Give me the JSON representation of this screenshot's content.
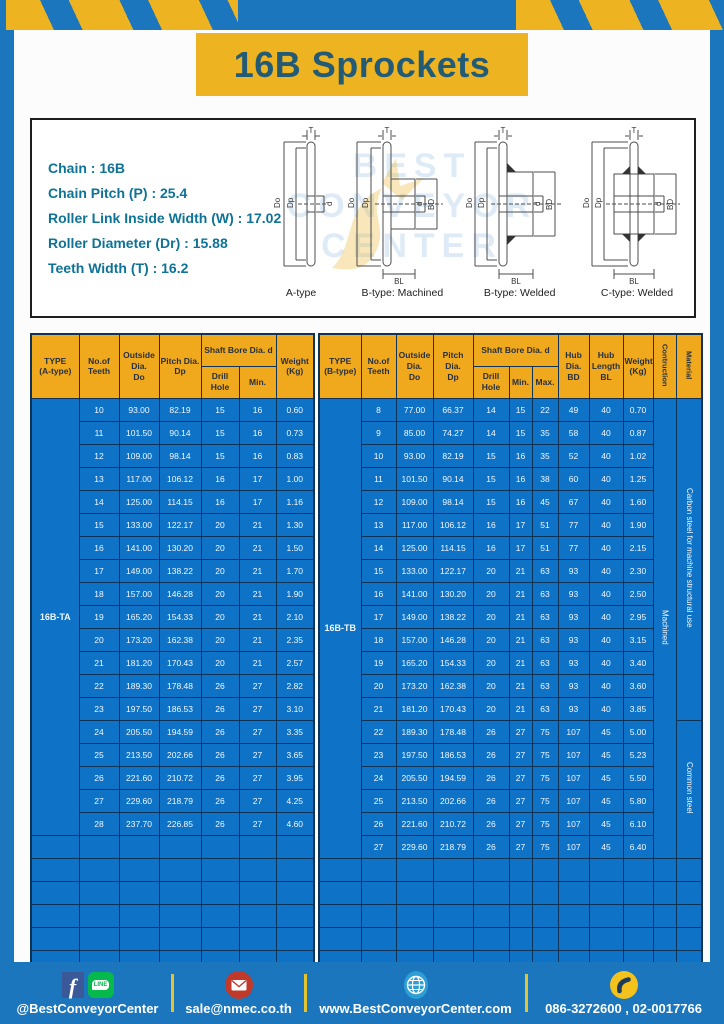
{
  "page": {
    "title": "16B Sprockets"
  },
  "colors": {
    "frame_blue": "#1b76bd",
    "banner_yellow": "#eeb321",
    "header_yellow": "#f0a91c",
    "table_blue": "#0e73c6",
    "title_text": "#235b77"
  },
  "specs": {
    "lines": [
      "Chain : 16B",
      "Chain Pitch (P) : 25.4",
      "Roller Link Inside Width (W) : 17.02",
      "Roller Diameter (Dr) : 15.88",
      "Teeth Width (T) : 16.2"
    ]
  },
  "diagram": {
    "captions": [
      "A-type",
      "B-type: Machined",
      "B-type: Welded",
      "C-type: Welded"
    ],
    "dims": {
      "T": "T",
      "Do": "Do",
      "Dp": "Dp",
      "d": "d",
      "BD": "BD",
      "BL": "BL"
    },
    "watermark_lines": [
      "BEST",
      "CONVEYOR",
      "CENTER"
    ]
  },
  "table_a": {
    "headers": {
      "type": "TYPE\n(A-type)",
      "teeth": "No.of\nTeeth",
      "outside": "Outside\nDia.\nDo",
      "pitch": "Pitch Dia.\nDp",
      "shaft_bore": "Shaft Bore Dia. d",
      "drill": "Drill Hole",
      "min": "Min.",
      "weight": "Weight\n(Kg)"
    },
    "type_label": "16B-TA",
    "rows": [
      [
        "10",
        "93.00",
        "82.19",
        "15",
        "16",
        "0.60"
      ],
      [
        "11",
        "101.50",
        "90.14",
        "15",
        "16",
        "0.73"
      ],
      [
        "12",
        "109.00",
        "98.14",
        "15",
        "16",
        "0.83"
      ],
      [
        "13",
        "117.00",
        "106.12",
        "16",
        "17",
        "1.00"
      ],
      [
        "14",
        "125.00",
        "114.15",
        "16",
        "17",
        "1.16"
      ],
      [
        "15",
        "133.00",
        "122.17",
        "20",
        "21",
        "1.30"
      ],
      [
        "16",
        "141.00",
        "130.20",
        "20",
        "21",
        "1.50"
      ],
      [
        "17",
        "149.00",
        "138.22",
        "20",
        "21",
        "1.70"
      ],
      [
        "18",
        "157.00",
        "146.28",
        "20",
        "21",
        "1.90"
      ],
      [
        "19",
        "165.20",
        "154.33",
        "20",
        "21",
        "2.10"
      ],
      [
        "20",
        "173.20",
        "162.38",
        "20",
        "21",
        "2.35"
      ],
      [
        "21",
        "181.20",
        "170.43",
        "20",
        "21",
        "2.57"
      ],
      [
        "22",
        "189.30",
        "178.48",
        "26",
        "27",
        "2.82"
      ],
      [
        "23",
        "197.50",
        "186.53",
        "26",
        "27",
        "3.10"
      ],
      [
        "24",
        "205.50",
        "194.59",
        "26",
        "27",
        "3.35"
      ],
      [
        "25",
        "213.50",
        "202.66",
        "26",
        "27",
        "3.65"
      ],
      [
        "26",
        "221.60",
        "210.72",
        "26",
        "27",
        "3.95"
      ],
      [
        "27",
        "229.60",
        "218.79",
        "26",
        "27",
        "4.25"
      ],
      [
        "28",
        "237.70",
        "226.85",
        "26",
        "27",
        "4.60"
      ]
    ],
    "empty_rows": 6
  },
  "table_b": {
    "headers": {
      "type": "TYPE\n(B-type)",
      "teeth": "No.of\nTeeth",
      "outside": "Outside\nDia.\nDo",
      "pitch": "Pitch Dia.\nDp",
      "shaft_bore": "Shaft Bore Dia. d",
      "drill": "Drill Hole",
      "min": "Min.",
      "max": "Max.",
      "hub_dia": "Hub Dia.\nBD",
      "hub_length": "Hub\nLength\nBL",
      "weight": "Weight\n(Kg)",
      "construction": "Contruction",
      "material": "Material"
    },
    "type_label": "16B-TB",
    "construction": "Machined",
    "materials": [
      {
        "label": "Carbon steel for machine structural use",
        "rows": 14
      },
      {
        "label": "Common steel",
        "rows": 6
      }
    ],
    "rows": [
      [
        "8",
        "77.00",
        "66.37",
        "14",
        "15",
        "22",
        "49",
        "40",
        "0.70"
      ],
      [
        "9",
        "85.00",
        "74.27",
        "14",
        "15",
        "35",
        "58",
        "40",
        "0.87"
      ],
      [
        "10",
        "93.00",
        "82.19",
        "15",
        "16",
        "35",
        "52",
        "40",
        "1.02"
      ],
      [
        "11",
        "101.50",
        "90.14",
        "15",
        "16",
        "38",
        "60",
        "40",
        "1.25"
      ],
      [
        "12",
        "109.00",
        "98.14",
        "15",
        "16",
        "45",
        "67",
        "40",
        "1.60"
      ],
      [
        "13",
        "117.00",
        "106.12",
        "16",
        "17",
        "51",
        "77",
        "40",
        "1.90"
      ],
      [
        "14",
        "125.00",
        "114.15",
        "16",
        "17",
        "51",
        "77",
        "40",
        "2.15"
      ],
      [
        "15",
        "133.00",
        "122.17",
        "20",
        "21",
        "63",
        "93",
        "40",
        "2.30"
      ],
      [
        "16",
        "141.00",
        "130.20",
        "20",
        "21",
        "63",
        "93",
        "40",
        "2.50"
      ],
      [
        "17",
        "149.00",
        "138.22",
        "20",
        "21",
        "63",
        "93",
        "40",
        "2.95"
      ],
      [
        "18",
        "157.00",
        "146.28",
        "20",
        "21",
        "63",
        "93",
        "40",
        "3.15"
      ],
      [
        "19",
        "165.20",
        "154.33",
        "20",
        "21",
        "63",
        "93",
        "40",
        "3.40"
      ],
      [
        "20",
        "173.20",
        "162.38",
        "20",
        "21",
        "63",
        "93",
        "40",
        "3.60"
      ],
      [
        "21",
        "181.20",
        "170.43",
        "20",
        "21",
        "63",
        "93",
        "40",
        "3.85"
      ],
      [
        "22",
        "189.30",
        "178.48",
        "26",
        "27",
        "75",
        "107",
        "45",
        "5.00"
      ],
      [
        "23",
        "197.50",
        "186.53",
        "26",
        "27",
        "75",
        "107",
        "45",
        "5.23"
      ],
      [
        "24",
        "205.50",
        "194.59",
        "26",
        "27",
        "75",
        "107",
        "45",
        "5.50"
      ],
      [
        "25",
        "213.50",
        "202.66",
        "26",
        "27",
        "75",
        "107",
        "45",
        "5.80"
      ],
      [
        "26",
        "221.60",
        "210.72",
        "26",
        "27",
        "75",
        "107",
        "45",
        "6.10"
      ],
      [
        "27",
        "229.60",
        "218.79",
        "26",
        "27",
        "75",
        "107",
        "45",
        "6.40"
      ]
    ],
    "empty_rows": 5
  },
  "footer": {
    "facebook_glyph": "f",
    "line_badge": "LINE",
    "items": [
      {
        "label": "@BestConveyorCenter"
      },
      {
        "label": "sale@nmec.co.th"
      },
      {
        "label": "www.BestConveyorCenter.com"
      },
      {
        "label": "086-3272600 , 02-0017766"
      }
    ]
  }
}
